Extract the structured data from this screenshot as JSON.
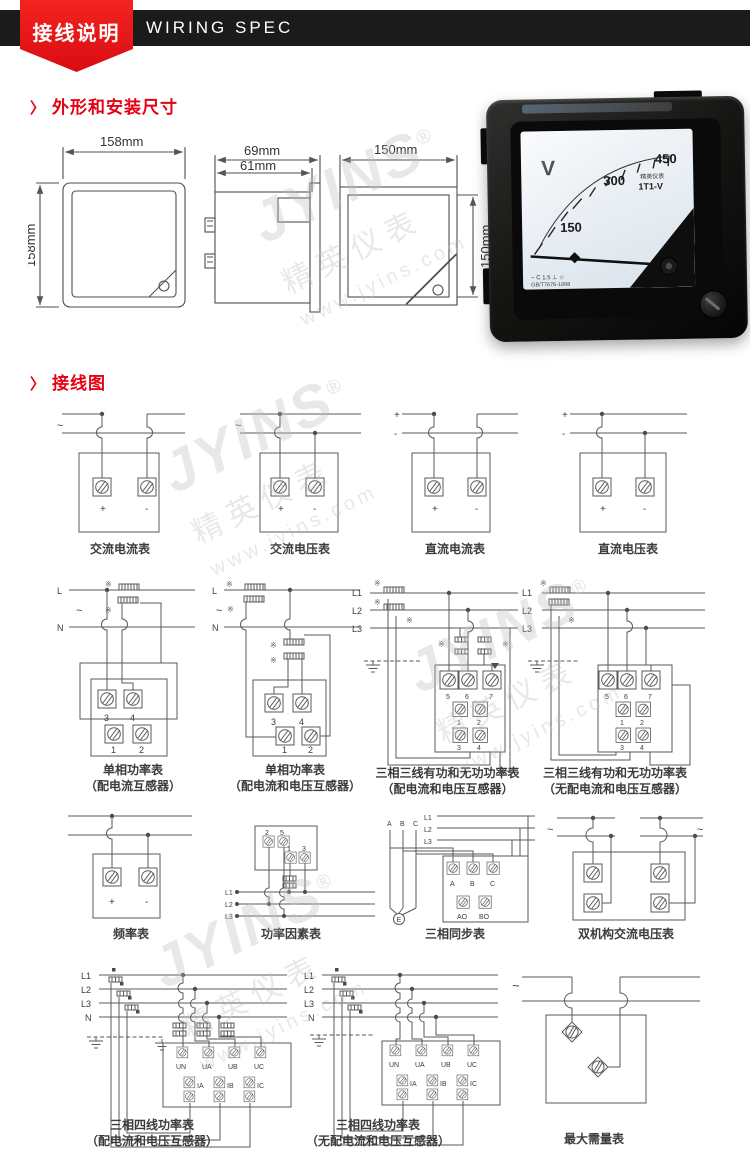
{
  "colors": {
    "accent": "#e60012",
    "bar": "#1b1b1b"
  },
  "header": {
    "zh": "接线说明",
    "en": "WIRING SPEC"
  },
  "sections": {
    "arrow": "〉",
    "dims_title": "外形和安装尺寸",
    "wiring_title": "接线图"
  },
  "dims": {
    "front_w": "158mm",
    "front_h": "158mm",
    "side_d": "69mm",
    "side_b": "61mm",
    "cut_w": "150mm",
    "cut_h": "150mm"
  },
  "meter": {
    "unit": "V",
    "ticks": [
      "150",
      "300",
      "450"
    ],
    "brand": "精英仪表",
    "model": "1T1-V",
    "class_line": "~ C 1.5 ⊥ ☆",
    "std_line": "GB/T7676-1998"
  },
  "watermark": {
    "brand": "JYINS",
    "reg": "®",
    "cn": "精英仪表",
    "url": "www.jyins.com"
  },
  "diagrams": [
    {
      "caption": "交流电流表",
      "src": "~",
      "plus": "+",
      "minus": "-"
    },
    {
      "caption": "交流电压表",
      "src": "~",
      "plus": "+",
      "minus": "-"
    },
    {
      "caption": "直流电流表",
      "lplus": "+",
      "lminus": "-",
      "plus": "+",
      "minus": "-"
    },
    {
      "caption": "直流电压表",
      "lplus": "+",
      "lminus": "-",
      "plus": "+",
      "minus": "-"
    },
    {
      "caption": "单相功率表",
      "caption2": "（配电流互感器）",
      "L": "L",
      "N": "N",
      "src": "~",
      "star": "※",
      "t": [
        "3",
        "4",
        "1",
        "2"
      ]
    },
    {
      "caption": "单相功率表",
      "caption2": "（配电流和电压互感器）",
      "L": "L",
      "N": "N",
      "src": "~",
      "star": "※",
      "t": [
        "3",
        "4",
        "1",
        "2"
      ]
    },
    {
      "caption": "三相三线有功和无功功率表",
      "caption2": "（配电流和电压互感器）",
      "lines": [
        "L1",
        "L2",
        "L3"
      ],
      "star": "※",
      "t": [
        "5",
        "6",
        "7",
        "1",
        "2",
        "3",
        "4"
      ]
    },
    {
      "caption": "三相三线有功和无功功率表",
      "caption2": "（无配电流和电压互感器）",
      "lines": [
        "L1",
        "L2",
        "L3"
      ],
      "star": "※",
      "t": [
        "5",
        "6",
        "7",
        "1",
        "2",
        "3",
        "4"
      ]
    },
    {
      "caption": "频率表",
      "plus": "+",
      "minus": "-"
    },
    {
      "caption": "功率因素表",
      "lines": [
        "L1",
        "L2",
        "L3"
      ],
      "t": [
        "2",
        "5",
        "1",
        "3"
      ]
    },
    {
      "caption": "三相同步表",
      "phases": [
        "A",
        "B",
        "C"
      ],
      "lines": [
        "L1",
        "L2",
        "L3"
      ],
      "t": [
        "A",
        "B",
        "C",
        "AO",
        "BO"
      ],
      "earth": "E"
    },
    {
      "caption": "双机构交流电压表",
      "src_l": "~",
      "src_r": "~"
    },
    {
      "caption": "三相四线功率表",
      "caption2": "（配电流和电压互感器）",
      "lines": [
        "L1",
        "L2",
        "L3",
        "N"
      ],
      "volts": [
        "UN",
        "UA",
        "UB",
        "UC"
      ],
      "amps": [
        "IA",
        "IB",
        "IC"
      ]
    },
    {
      "caption": "三相四线功率表",
      "caption2": "（无配电流和电压互感器）",
      "lines": [
        "L1",
        "L2",
        "L3",
        "N"
      ],
      "volts": [
        "UN",
        "UA",
        "UB",
        "UC"
      ],
      "amps": [
        "IA",
        "IB",
        "IC"
      ]
    },
    {
      "caption": "最大需量表",
      "src": "~"
    }
  ]
}
